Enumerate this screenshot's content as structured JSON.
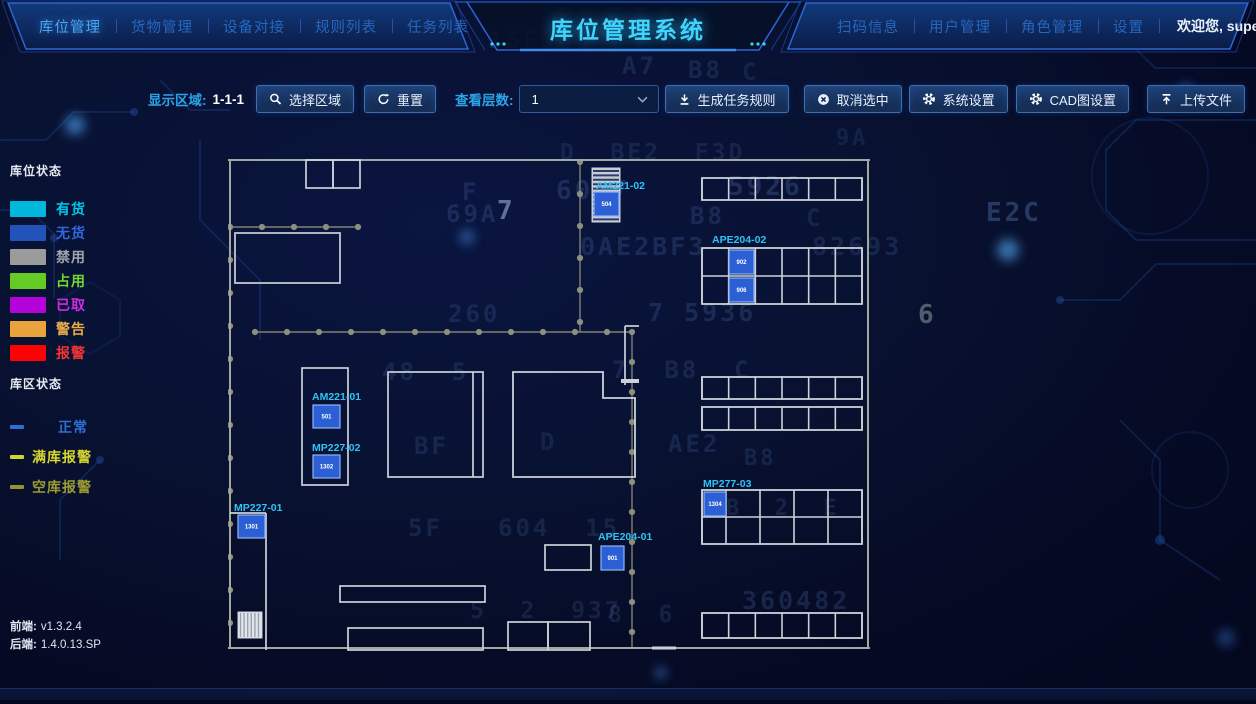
{
  "app": {
    "title": "库位管理系统",
    "welcome": "欢迎您, super"
  },
  "nav_left": [
    {
      "label": "库位管理",
      "active": true
    },
    {
      "label": "货物管理"
    },
    {
      "label": "设备对接"
    },
    {
      "label": "规则列表"
    },
    {
      "label": "任务列表"
    }
  ],
  "nav_right": [
    {
      "label": "扫码信息"
    },
    {
      "label": "用户管理"
    },
    {
      "label": "角色管理"
    },
    {
      "label": "设置"
    }
  ],
  "toolbar": {
    "display_area_label": "显示区域:",
    "display_area_value": "1-1-1",
    "select_area_label": "选择区域",
    "reset_label": "重置",
    "layers_label": "查看层数:",
    "layers_value": "1",
    "generate_label": "生成任务规则",
    "cancel_label": "取消选中",
    "system_label": "系统设置",
    "cad_label": "CAD图设置",
    "upload_label": "上传文件"
  },
  "legend": {
    "slot_title": "库位状态",
    "slot_items": [
      {
        "label": "有货",
        "color": "#00b8dc",
        "text": "#00c8ee"
      },
      {
        "label": "无货",
        "color": "#2253bb",
        "text": "#3068e0"
      },
      {
        "label": "禁用",
        "color": "#9b9b9b",
        "text": "#a0a6ad"
      },
      {
        "label": "占用",
        "color": "#64cb24",
        "text": "#74d832"
      },
      {
        "label": "已取",
        "color": "#b303d9",
        "text": "#cb2de4"
      },
      {
        "label": "警告",
        "color": "#e8a33c",
        "text": "#eaae49"
      },
      {
        "label": "报警",
        "color": "#fc0204",
        "text": "#f73434"
      }
    ],
    "zone_title": "库区状态",
    "zone_items": [
      {
        "label": "正常",
        "color": "#2e6fd2",
        "text": "#2f6fd4",
        "pad": 26
      },
      {
        "label": "满库报警",
        "color": "#d2d32b",
        "text": "#d6d62e",
        "pad": 0
      },
      {
        "label": "空库报警",
        "color": "#93942c",
        "text": "#9b9c30",
        "pad": 0
      }
    ]
  },
  "versions": {
    "frontend_label": "前端:",
    "frontend_value": "v1.3.2.4",
    "backend_label": "后端:",
    "backend_value": "1.4.0.13.SP"
  },
  "cad": {
    "x": 228,
    "y": 156,
    "w": 644,
    "h": 498,
    "wall_color": "#a3a89f",
    "rack_color": "#ccd1d9",
    "dot_color": "#8e8e7d",
    "label_color": "#2fc3f4",
    "cell_fill": "#2b5fd3",
    "cell_border": "#8fb4f8",
    "walls": [
      [
        0,
        4,
        642,
        4
      ],
      [
        2,
        4,
        2,
        492
      ],
      [
        640,
        4,
        640,
        492
      ],
      [
        0,
        492,
        642,
        492
      ]
    ],
    "dotted": [
      {
        "x1": 2,
        "y1": 71,
        "x2": 132,
        "y2": 71,
        "step": 32
      },
      {
        "x1": 27,
        "y1": 176,
        "x2": 404,
        "y2": 176,
        "step": 32
      },
      {
        "x1": 352,
        "y1": 6,
        "x2": 352,
        "y2": 176,
        "step": 32
      },
      {
        "x1": 2,
        "y1": 71,
        "x2": 2,
        "y2": 490,
        "step": 33
      },
      {
        "x1": 404,
        "y1": 176,
        "x2": 404,
        "y2": 492,
        "step": 30
      }
    ],
    "rects": [
      [
        78,
        4,
        27,
        28
      ],
      [
        105,
        4,
        27,
        28
      ],
      [
        7,
        77,
        105,
        50
      ],
      [
        160,
        216,
        95,
        105
      ],
      [
        74,
        212,
        46,
        117
      ],
      [
        317,
        389,
        46,
        25
      ],
      [
        112,
        430,
        145,
        16
      ],
      [
        120,
        472,
        135,
        22
      ],
      [
        280,
        466,
        40,
        28
      ],
      [
        320,
        466,
        42,
        28
      ]
    ],
    "lines": [
      [
        245,
        216,
        245,
        321
      ],
      [
        397,
        170,
        397,
        229
      ],
      [
        397,
        170,
        411,
        170
      ],
      [
        393,
        225,
        411,
        225,
        4
      ],
      [
        2,
        357,
        38,
        357
      ],
      [
        38,
        357,
        38,
        494
      ],
      [
        424,
        492,
        448,
        492,
        3
      ]
    ],
    "polygons": [
      [
        285,
        216,
        375,
        216,
        375,
        242,
        407,
        242,
        407,
        321,
        285,
        321
      ]
    ],
    "grids": [
      {
        "x": 474,
        "y": 22,
        "w": 160,
        "h": 22,
        "cols": 6,
        "rows": 1
      },
      {
        "x": 474,
        "y": 92,
        "w": 160,
        "h": 56,
        "cols": 6,
        "rows": 2
      },
      {
        "x": 474,
        "y": 221,
        "w": 160,
        "h": 22,
        "cols": 6,
        "rows": 1
      },
      {
        "x": 474,
        "y": 251,
        "w": 160,
        "h": 23,
        "cols": 6,
        "rows": 1
      },
      {
        "x": 474,
        "y": 334,
        "w": 160,
        "h": 54,
        "cols": 5,
        "rows": 2,
        "col_xs": [
          474,
          498,
          532,
          566,
          600,
          634
        ]
      },
      {
        "x": 474,
        "y": 457,
        "w": 160,
        "h": 25,
        "cols": 6,
        "rows": 1
      }
    ],
    "striped": [
      {
        "x": 364,
        "y": 12,
        "w": 28,
        "h": 54,
        "dir": "h"
      },
      {
        "x": 10,
        "y": 456,
        "w": 24,
        "h": 26,
        "dir": "v"
      }
    ],
    "cells": [
      {
        "x": 366,
        "y": 36,
        "w": 25,
        "h": 24,
        "num": "504"
      },
      {
        "x": 501,
        "y": 94,
        "w": 25,
        "h": 24,
        "num": "902"
      },
      {
        "x": 501,
        "y": 122,
        "w": 25,
        "h": 24,
        "num": "906"
      },
      {
        "x": 85,
        "y": 249,
        "w": 27,
        "h": 23,
        "num": "501"
      },
      {
        "x": 85,
        "y": 299,
        "w": 27,
        "h": 23,
        "num": "1302"
      },
      {
        "x": 10,
        "y": 359,
        "w": 27,
        "h": 23,
        "num": "1301"
      },
      {
        "x": 373,
        "y": 390,
        "w": 23,
        "h": 24,
        "num": "901"
      },
      {
        "x": 476,
        "y": 336,
        "w": 22,
        "h": 24,
        "num": "1304"
      }
    ],
    "labels": [
      {
        "x": 368,
        "y": 33,
        "t": "AM221-02"
      },
      {
        "x": 484,
        "y": 87,
        "t": "APE204-02"
      },
      {
        "x": 84,
        "y": 244,
        "t": "AM221-01"
      },
      {
        "x": 84,
        "y": 295,
        "t": "MP227-02"
      },
      {
        "x": 6,
        "y": 355,
        "t": "MP227-01"
      },
      {
        "x": 370,
        "y": 384,
        "t": "APE204-01"
      },
      {
        "x": 475,
        "y": 331,
        "t": "MP277-03"
      }
    ]
  },
  "background": {
    "glyphs": [
      {
        "t": "15F3604",
        "x": 488,
        "y": 26,
        "s": 24,
        "o": 0.1
      },
      {
        "t": "A7",
        "x": 622,
        "y": 52,
        "s": 24,
        "o": 0.13
      },
      {
        "t": "B8",
        "x": 688,
        "y": 56,
        "s": 24,
        "o": 0.13
      },
      {
        "t": "C",
        "x": 742,
        "y": 58,
        "s": 24,
        "o": 0.11
      },
      {
        "t": "9A",
        "x": 836,
        "y": 126,
        "s": 22,
        "o": 0.1
      },
      {
        "t": "D  BE2  F3D",
        "x": 560,
        "y": 140,
        "s": 23,
        "o": 0.11
      },
      {
        "t": "F",
        "x": 462,
        "y": 178,
        "s": 24,
        "o": 0.14
      },
      {
        "t": "6047",
        "x": 556,
        "y": 176,
        "s": 26,
        "o": 0.16
      },
      {
        "t": "5926",
        "x": 728,
        "y": 172,
        "s": 26,
        "o": 0.18
      },
      {
        "t": "69A",
        "x": 446,
        "y": 200,
        "s": 24,
        "o": 0.15
      },
      {
        "t": "7",
        "x": 497,
        "y": 196,
        "s": 26,
        "o": 0.45,
        "c": "#cfe0ff"
      },
      {
        "t": "B8",
        "x": 690,
        "y": 202,
        "s": 24,
        "o": 0.14
      },
      {
        "t": "C",
        "x": 806,
        "y": 204,
        "s": 24,
        "o": 0.12
      },
      {
        "t": "E2C",
        "x": 986,
        "y": 198,
        "s": 26,
        "o": 0.26
      },
      {
        "t": "0AE2BF3",
        "x": 580,
        "y": 232,
        "s": 25,
        "o": 0.15
      },
      {
        "t": "82693",
        "x": 812,
        "y": 232,
        "s": 25,
        "o": 0.13
      },
      {
        "t": "260",
        "x": 448,
        "y": 300,
        "s": 24,
        "o": 0.13
      },
      {
        "t": "7 5936",
        "x": 648,
        "y": 298,
        "s": 25,
        "o": 0.15
      },
      {
        "t": "6",
        "x": 918,
        "y": 300,
        "s": 26,
        "o": 0.35,
        "c": "#d8e8d8"
      },
      {
        "t": "48  5",
        "x": 382,
        "y": 358,
        "s": 24,
        "o": 0.13
      },
      {
        "t": "7  B8  C",
        "x": 612,
        "y": 356,
        "s": 24,
        "o": 0.13
      },
      {
        "t": "BF",
        "x": 414,
        "y": 432,
        "s": 24,
        "o": 0.13
      },
      {
        "t": "D",
        "x": 540,
        "y": 428,
        "s": 24,
        "o": 0.11
      },
      {
        "t": "AE2",
        "x": 668,
        "y": 430,
        "s": 24,
        "o": 0.13
      },
      {
        "t": "B8",
        "x": 744,
        "y": 446,
        "s": 22,
        "o": 0.12
      },
      {
        "t": "B  2  E",
        "x": 726,
        "y": 496,
        "s": 22,
        "o": 0.12
      },
      {
        "t": "5F",
        "x": 408,
        "y": 514,
        "s": 24,
        "o": 0.12
      },
      {
        "t": "604  15",
        "x": 498,
        "y": 514,
        "s": 24,
        "o": 0.12
      },
      {
        "t": "360482",
        "x": 742,
        "y": 586,
        "s": 25,
        "o": 0.15
      },
      {
        "t": "5  2  937",
        "x": 470,
        "y": 598,
        "s": 23,
        "o": 0.12
      },
      {
        "t": "8  6",
        "x": 608,
        "y": 602,
        "s": 23,
        "o": 0.12
      }
    ]
  }
}
